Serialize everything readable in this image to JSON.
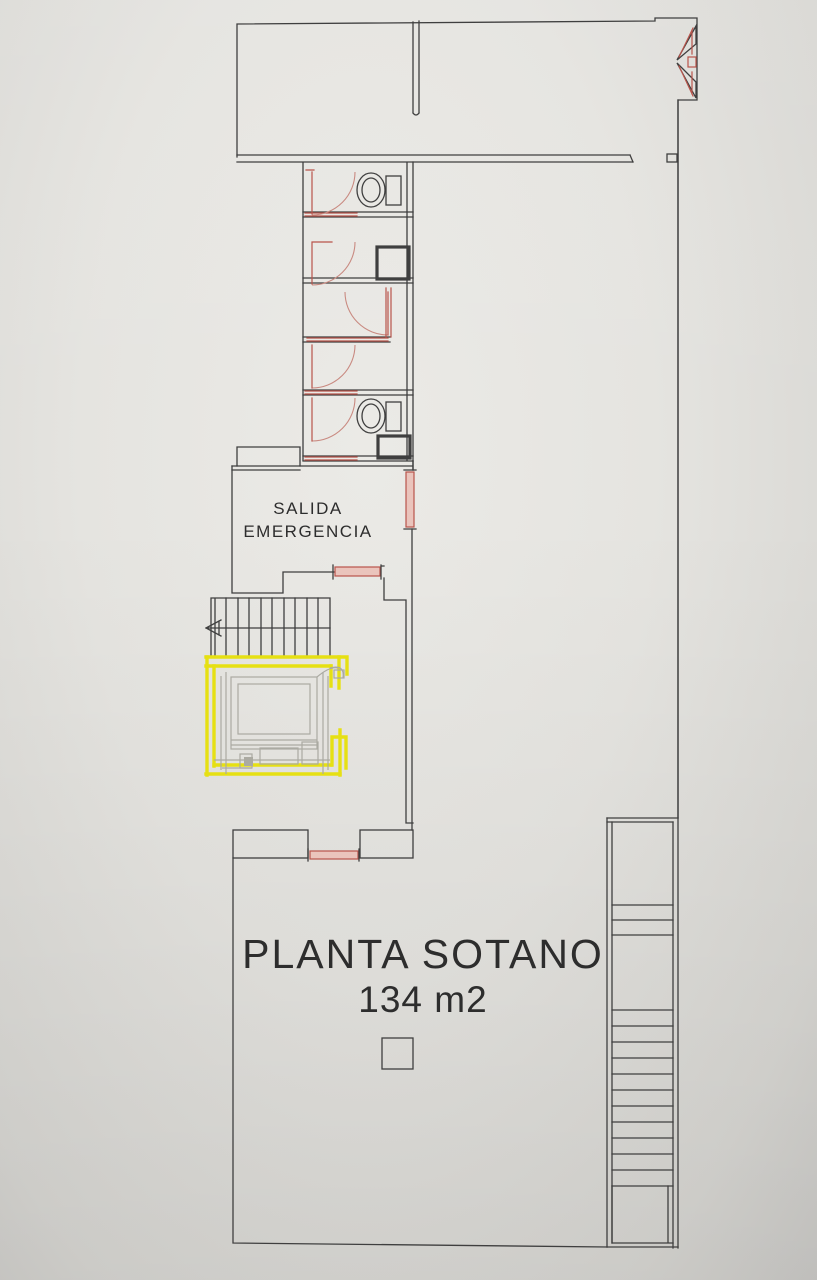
{
  "document": {
    "kind": "basement floor plan photo",
    "labels": {
      "emergency_exit_line1": "SALIDA",
      "emergency_exit_line2": "EMERGENCIA",
      "plan_title": "PLANTA SOTANO",
      "plan_area": "134 m2"
    },
    "colors": {
      "paper_light": "#ebeae6",
      "paper": "#e5e4e0",
      "paper_dark": "#d8d7d3",
      "paper_edge": "#cbcac7",
      "line": "#3f3f3f",
      "text": "#2d2d2d",
      "door_red": "#b9544b",
      "door_arc": "#c98a81",
      "door_fill": "#eac4bc",
      "highlight_yellow": "#e6e013",
      "elevator_gray": "#abaaa2"
    }
  }
}
